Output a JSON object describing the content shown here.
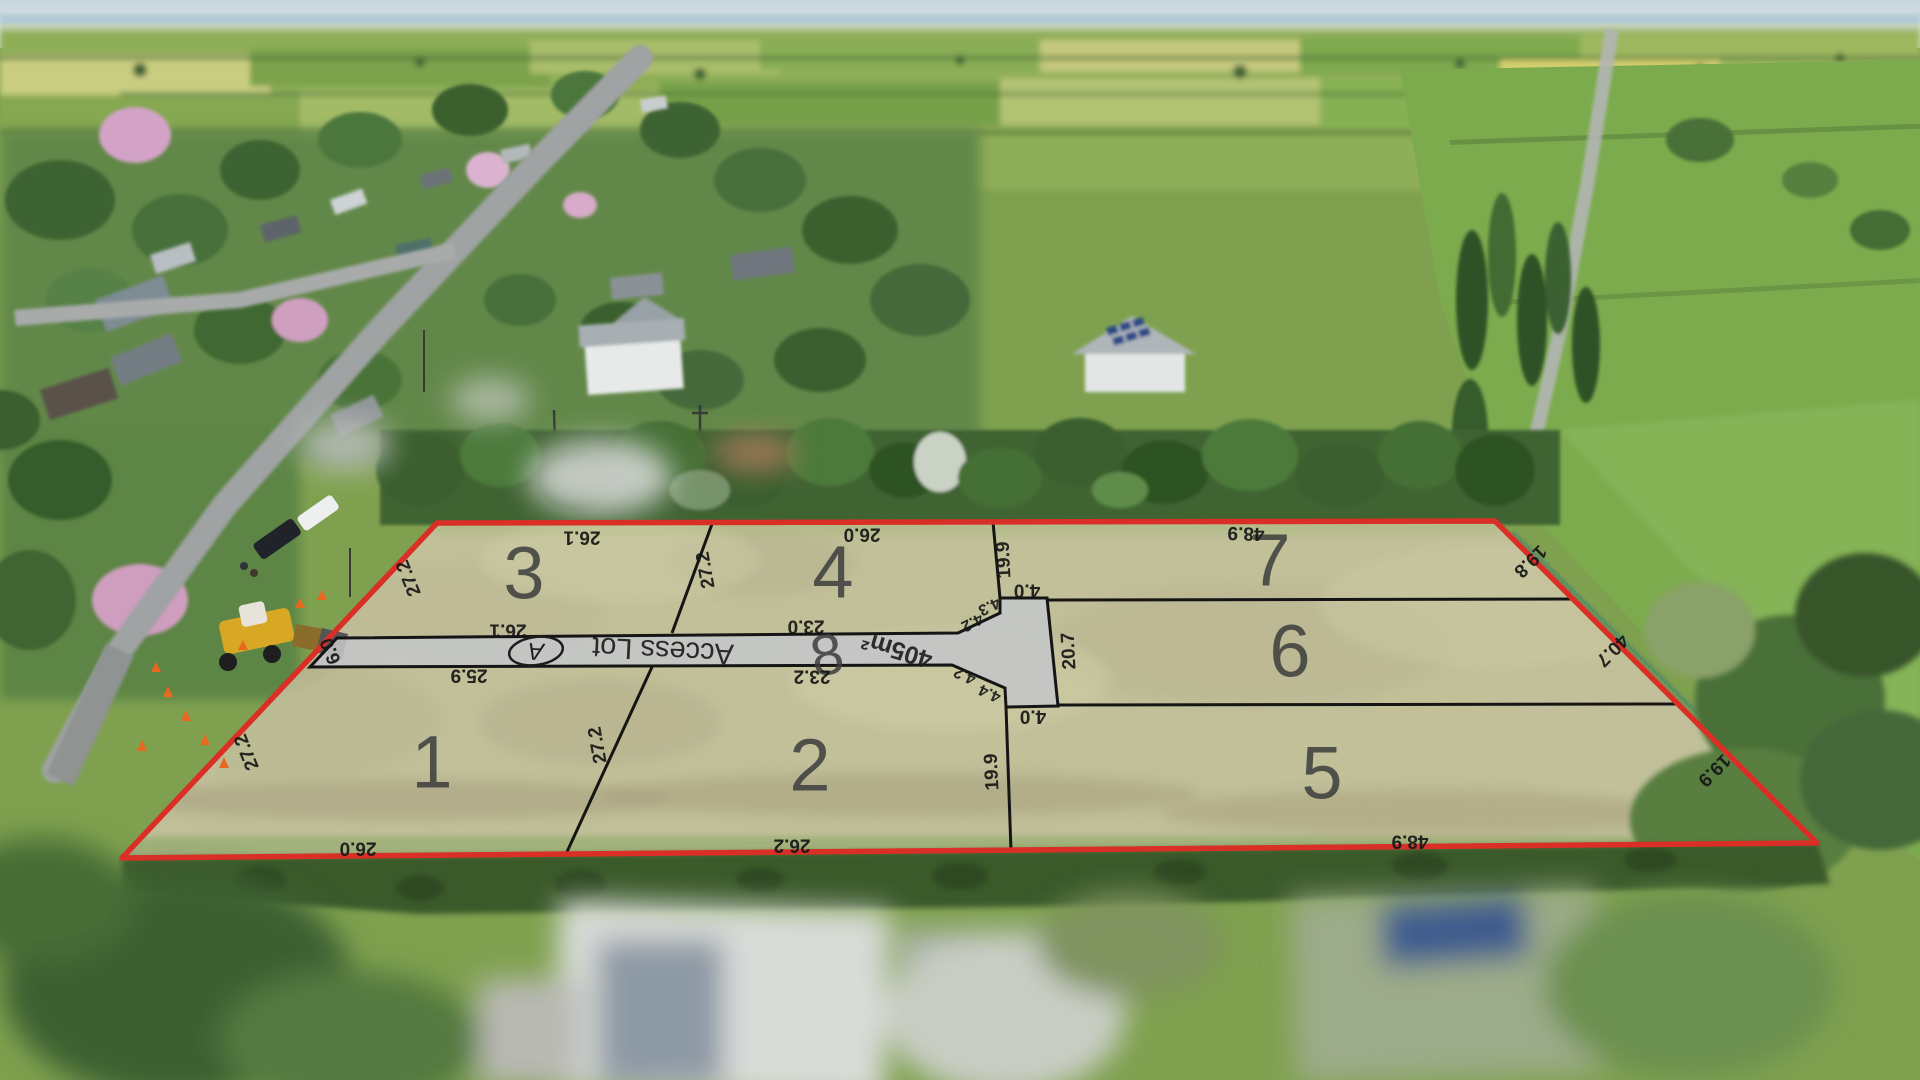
{
  "site": {
    "lots": {
      "lot1": "1",
      "lot2": "2",
      "lot3": "3",
      "lot4": "4",
      "lot5": "5",
      "lot6": "6",
      "lot7": "7",
      "lot8": "8"
    },
    "access": {
      "badge": "A",
      "label": "Access Lot",
      "area": "405m²"
    },
    "dimensions": {
      "lot3_top": "26.1",
      "lot4_top": "26.0",
      "lot7_top": "48.9",
      "lot7_right": "19.8",
      "lot6_right": "40.7",
      "lot5_right": "19.9",
      "lot5_bottom": "48.9",
      "lot2_bottom": "26.2",
      "lot1_bottom": "26.0",
      "lot1_left": "27.2",
      "lot3_left": "27.2",
      "access_entry_width": "6.0",
      "lot3_bottom": "26.1",
      "lot4_bottom": "23.0",
      "lot1_top": "25.9",
      "lot2_top": "23.2",
      "lot3_lot4_boundary": "27.2",
      "lot1_lot2_boundary": "27.2",
      "lot4_right": "19.9",
      "lot2_right": "19.9",
      "lot6_left": "20.7",
      "access_block_top_width": "4.0",
      "access_block_bottom_width": "4.0",
      "flare_top_outer": "4.3",
      "flare_top_inner": "4.2",
      "flare_bottom_inner": "4.2",
      "flare_bottom_outer": "4.4"
    },
    "palette": {
      "boundary_red": "#d92f26",
      "lot_line_black": "#151515",
      "access_lot_grey": "#c4c6c8",
      "paddock_tint": "#e9e5c6",
      "label_color": "#171717",
      "lot_number_grey": "#3d3d3d"
    }
  }
}
